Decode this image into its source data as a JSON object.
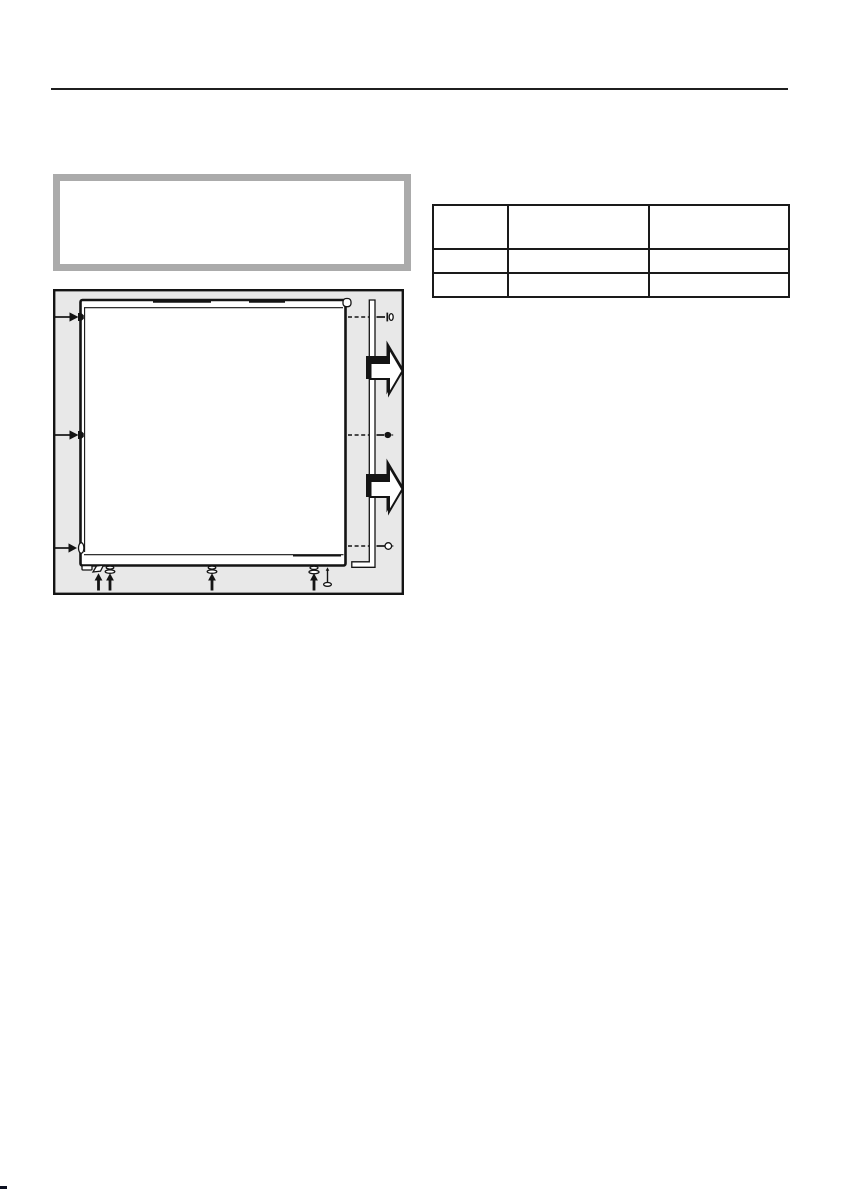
{
  "colors": {
    "page-bg": "#ffffff",
    "ink": "#141414",
    "rule": "#1f1f1f",
    "callout-border": "#ababab",
    "figure-bg": "#e8e8e8",
    "table-border": "#1a1a1a",
    "corner-mark": "#0c1020"
  },
  "header": {
    "rule": true
  },
  "callout_box": {
    "text": ""
  },
  "figure": {
    "type": "installation-diagram",
    "caption": "",
    "elements": [
      "side-panel",
      "panel-top-lid",
      "fastener-arrow-left-top",
      "fastener-arrow-left-middle",
      "fastener-arrow-left-bottom",
      "hinge-pin",
      "mounting-rail",
      "screw-top",
      "screw-middle",
      "screw-bottom",
      "direction-arrow-upper",
      "direction-arrow-lower",
      "leveling-foot-1",
      "leveling-foot-2",
      "leveling-foot-3",
      "leveling-foot-4",
      "base-screw"
    ]
  },
  "spec_table": {
    "rows": [
      [
        "",
        "",
        ""
      ],
      [
        "",
        "",
        ""
      ],
      [
        "",
        "",
        ""
      ]
    ]
  }
}
